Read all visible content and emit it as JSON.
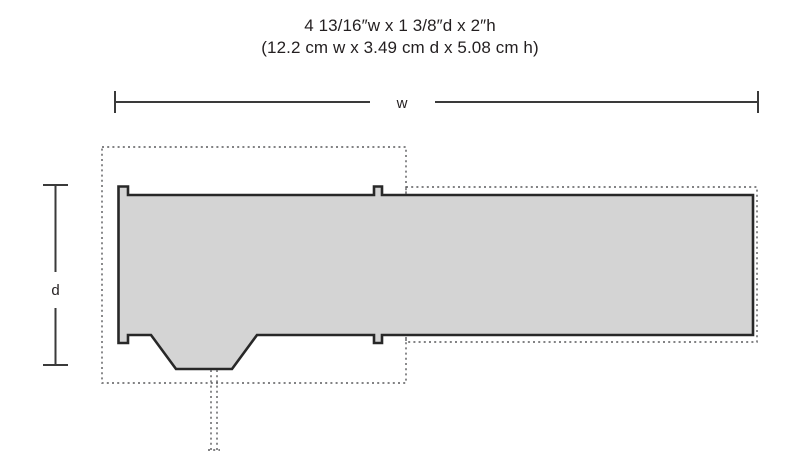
{
  "title": {
    "imperial": "4 13/16″w x 1 3/8″d x 2″h",
    "metric": "(12.2 cm w x 3.49 cm d x 5.08 cm h)"
  },
  "dimension_labels": {
    "width": "w",
    "depth": "d"
  },
  "measurements": {
    "width_imperial": "4 13/16″",
    "depth_imperial": "1 3/8″",
    "height_imperial": "2″",
    "width_metric": "12.2 cm",
    "depth_metric": "3.49 cm",
    "height_metric": "5.08 cm"
  },
  "colors": {
    "outline": "#282828",
    "fill": "#d4d4d4",
    "dashed": "#58595b",
    "dimension_line": "#3a3a3a",
    "text": "#231f20",
    "background": "#ffffff"
  }
}
